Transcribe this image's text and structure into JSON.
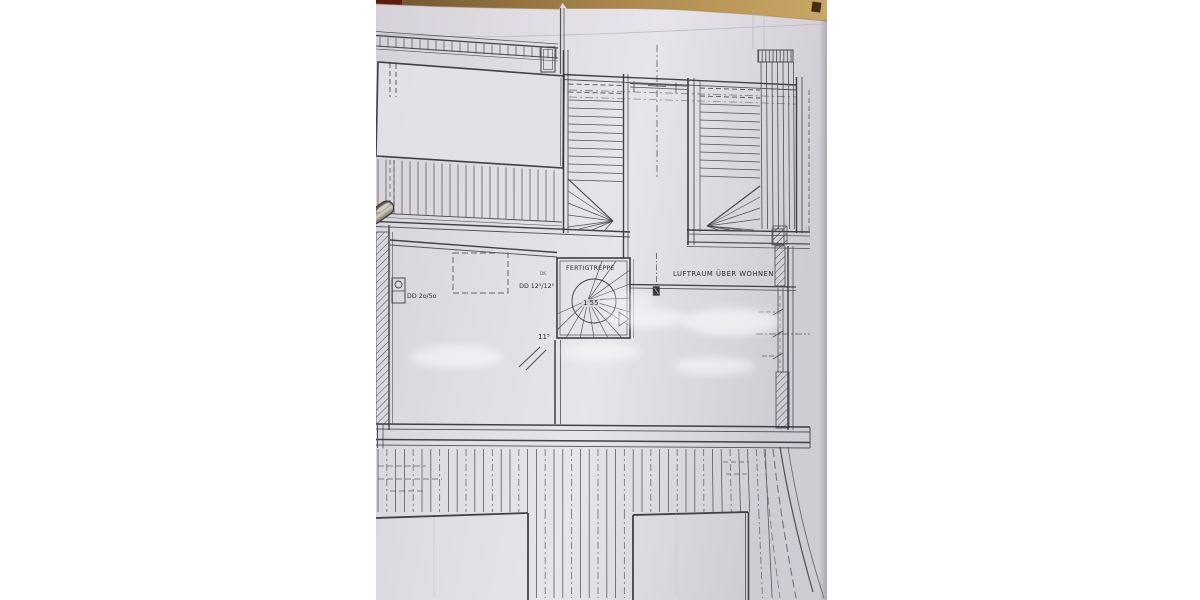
{
  "scene": {
    "type": "photo of an architectural floor plan lying on a wooden desk",
    "colors": {
      "page_background": "#ffffff",
      "paper": "#dfdde2",
      "desk_wood": "#a9884e",
      "desk_dark_red": "#5a1d10",
      "ink": "#45424b"
    }
  },
  "plan": {
    "labels": {
      "stair_name": "FERTIGTREPPE",
      "stair_dimension": "1 55",
      "air_space": "LUFTRAUM ÜBER WOHNEN",
      "duct_left": "DD 2o/5o",
      "duct_middle": "DD 12⁵/12⁵",
      "duct_middle_mark": "DK",
      "wall_dimension": "11⁵"
    }
  }
}
